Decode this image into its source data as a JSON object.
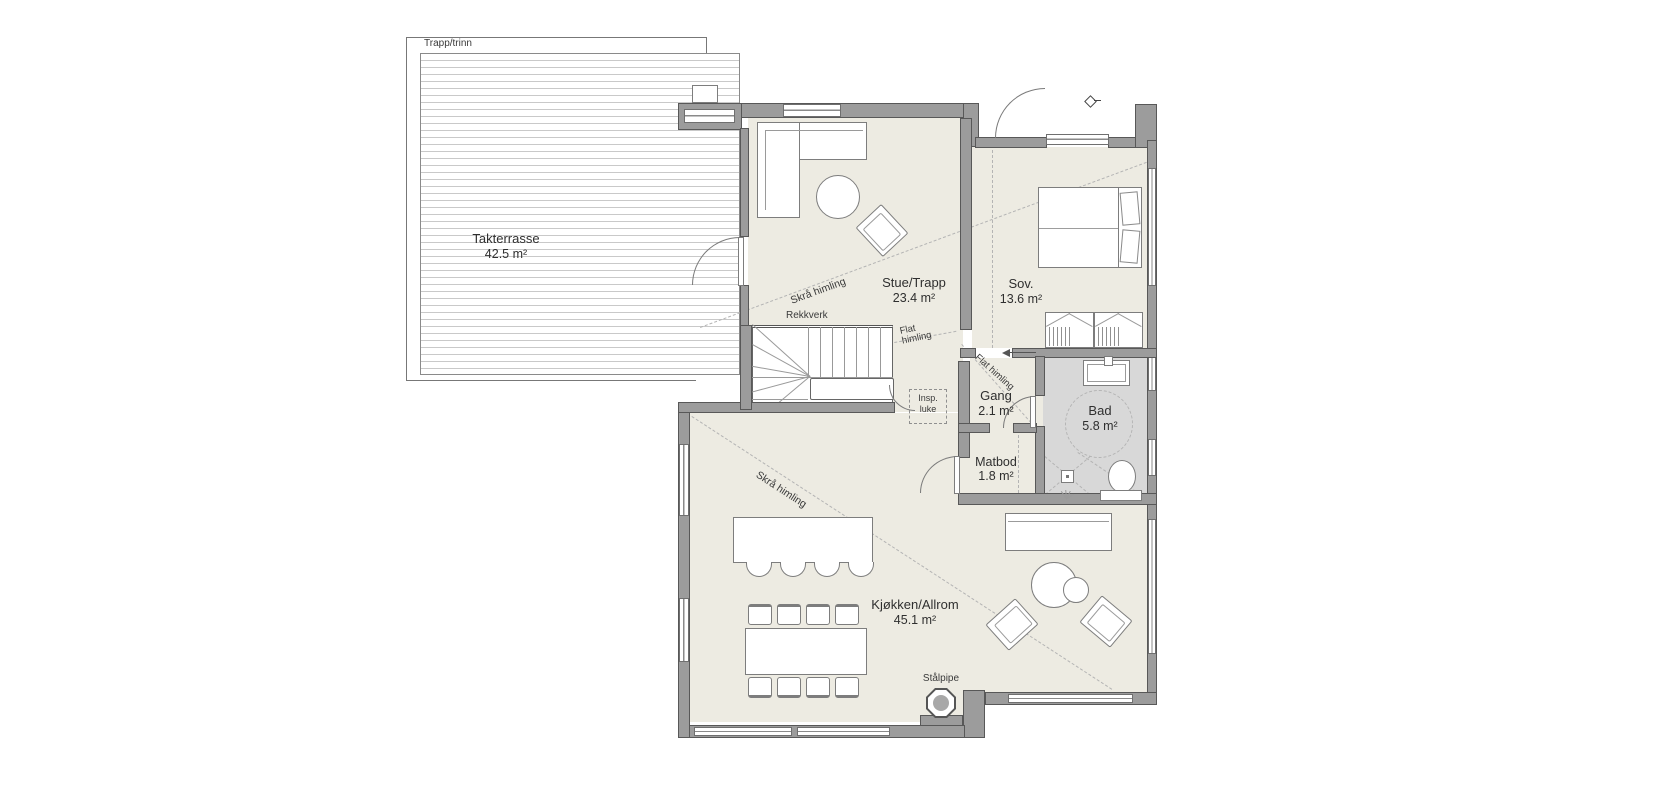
{
  "plan": {
    "rooms": {
      "takterrasse": {
        "name": "Takterrasse",
        "area": "42.5 m²"
      },
      "stue": {
        "name": "Stue/Trapp",
        "area": "23.4 m²"
      },
      "sov": {
        "name": "Sov.",
        "area": "13.6 m²"
      },
      "bad": {
        "name": "Bad",
        "area": "5.8 m²"
      },
      "gang": {
        "name": "Gang",
        "area": "2.1 m²"
      },
      "matbod": {
        "name": "Matbod",
        "area": "1.8 m²"
      },
      "kjokken": {
        "name": "Kjøkken/Allrom",
        "area": "45.1 m²"
      }
    },
    "notes": {
      "trapp_trinn": "Trapp/trinn",
      "rekkverk": "Rekkverk",
      "skra_himling_stue": "Skrå himling",
      "skra_himling_kjokken": "Skrå himling",
      "flat_himling_gang_line1": "Flat",
      "flat_himling_gang_line2": "himling",
      "flat_himling_bad": "Flat himling",
      "insp_luke_line1": "Insp.",
      "insp_luke_line2": "luke",
      "stalpipe": "Stålpipe"
    },
    "colors": {
      "floor": "#edebe2",
      "bath_floor": "#d8d8d8",
      "wall": "#9c9c9c",
      "wall_edge": "#585858",
      "dash_line": "#b4b4b4",
      "deck_line": "#c9c9c9"
    }
  }
}
